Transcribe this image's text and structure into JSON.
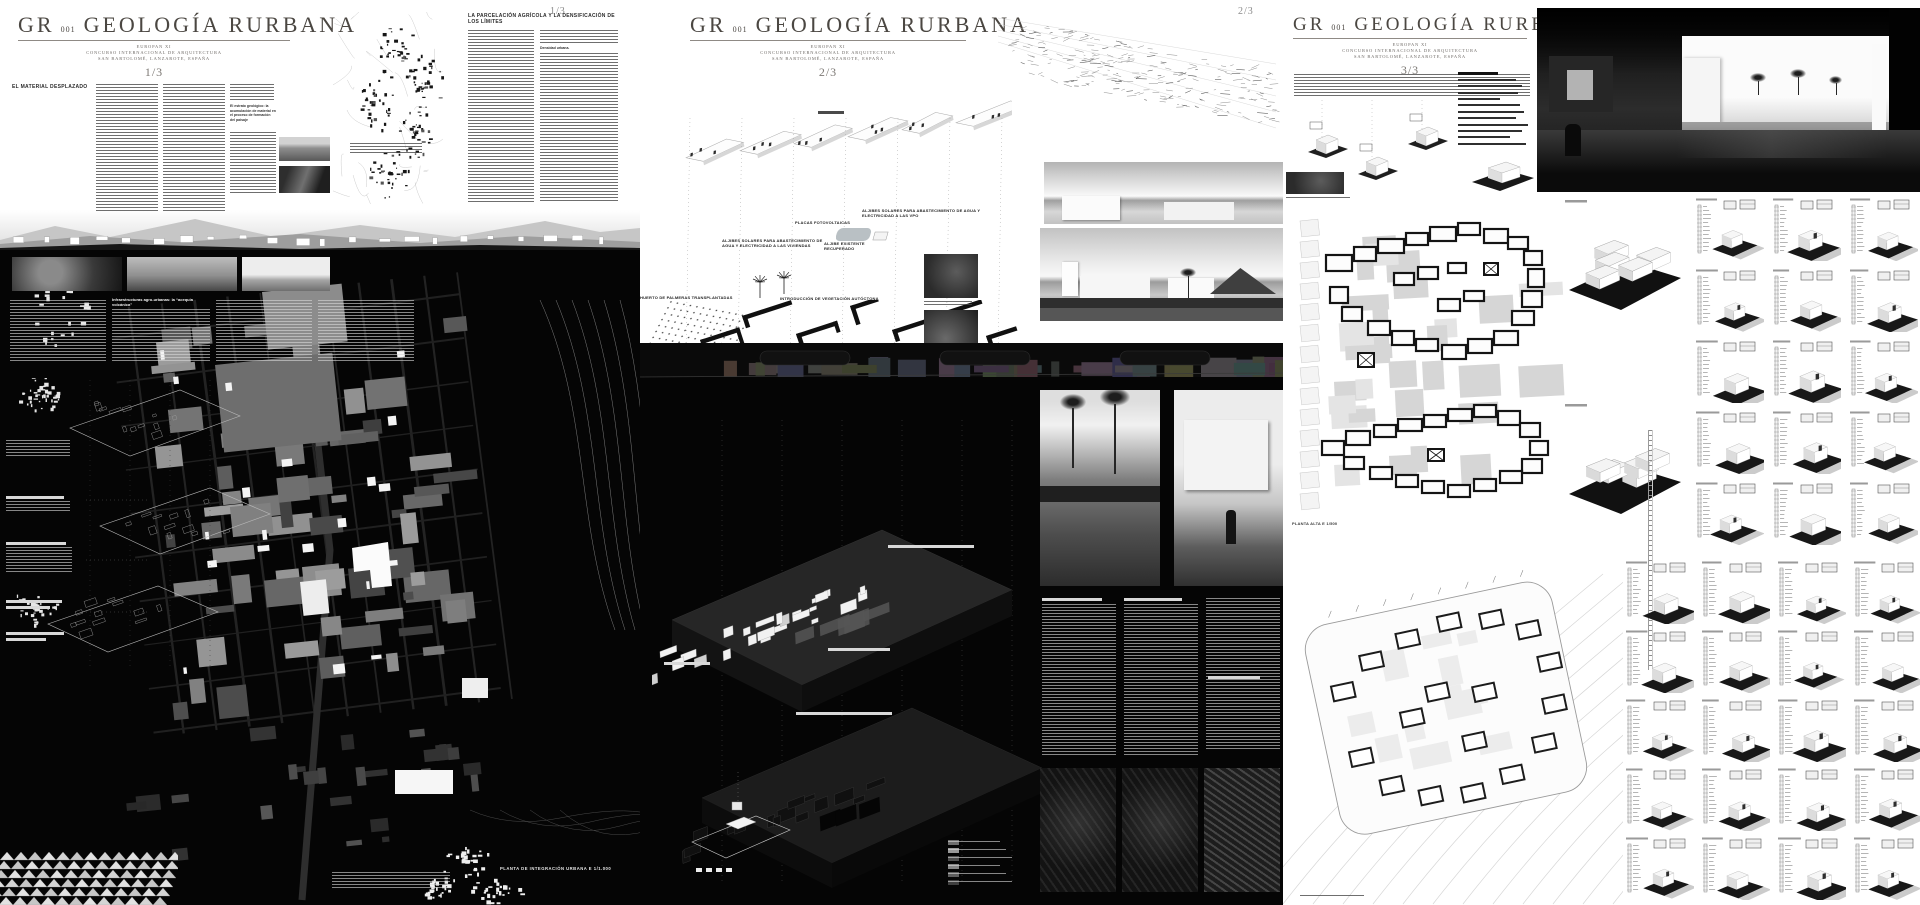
{
  "colors": {
    "page_bg": "#ffffff",
    "ink": "#3d3a37",
    "title": "#4b4742",
    "muted": "#8a8a8a",
    "dark_panel": "#050505"
  },
  "project": {
    "code": "GR",
    "code_sub": "001",
    "title": "GEOLOGÍA RURBANA",
    "org": "EUROPAN XI",
    "line2": "CONCURSO INTERNACIONAL DE ARQUITECTURA",
    "loc": "SAN BARTOLOMÉ, LANZAROTE, ESPAÑA"
  },
  "panel1": {
    "page": "1/3",
    "corner_page": "1/3",
    "heading_material": "EL MATERIAL DESPLAZADO",
    "subheading_estrato": "El estrato geológico: la acumulación de material en el proceso de formación del paisaje",
    "heading_parcelacion": "LA PARCELACIÓN AGRÍCOLA Y LA DENSIFICACIÓN DE LOS LÍMITES",
    "inline_densidad": "Densidad urbana.",
    "heading_infra": "Infraestructuras agro-urbanas: la “acequia volcánica”",
    "plan_label": "PLANTA DE INTEGRACIÓN URBANA E 1/1.000"
  },
  "panel2": {
    "page": "2/3",
    "corner_page": "2/3",
    "labels": {
      "aljibes_vpo": "ALJIBES SOLARES PARA ABASTECIMIENTO DE AGUA Y ELECTRICIDAD A LAS VPO",
      "placas": "PLACAS FOTOVOLTAICAS",
      "aljibes_viviendas": "ALJIBES SOLARES PARA ABASTECIMIENTO DE AGUA Y ELECTRICIDAD A LAS VIVIENDAS",
      "aljibe_existente": "ALJIBE EXISTENTE RECUPERADO",
      "palmeras": "HUERTO DE PALMERAS TRANSPLANTADAS",
      "vegetacion": "INTRODUCCIÓN DE VEGETACIÓN AUTÓCTONA"
    }
  },
  "panel3": {
    "page": "3/3",
    "plan1_label": "PLANTA ALTA E 1/500"
  }
}
